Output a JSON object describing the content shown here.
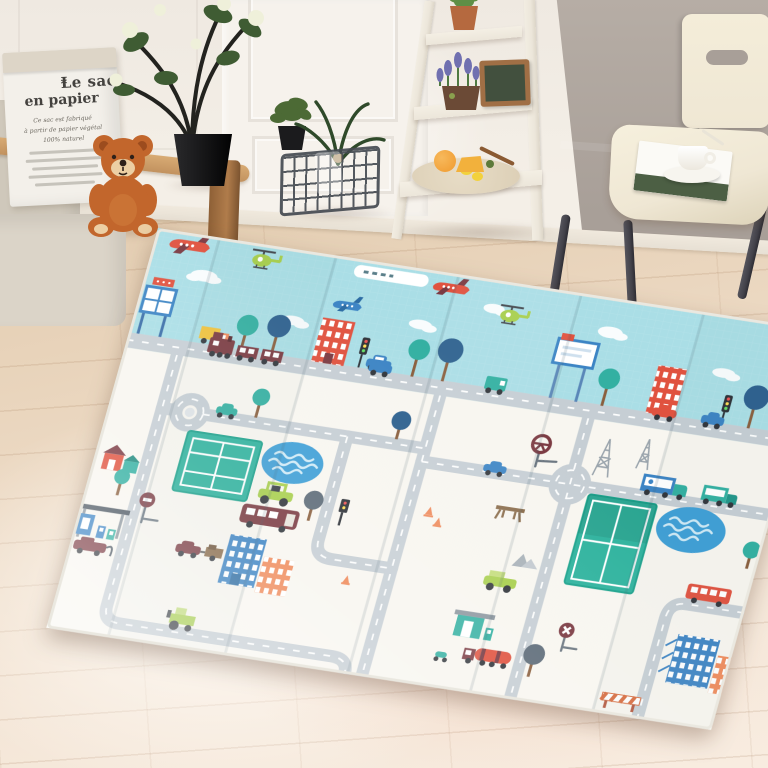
{
  "scene": {
    "title": "Living room with foldable baby play mat",
    "type": "product photograph"
  },
  "colors": {
    "wall_left": "#efe9e1",
    "wall_right": "#a89f98",
    "door": "#f6f2ec",
    "baseboard": "#e7e0d4",
    "floor": "#ecd9c3",
    "floor_deep": "#e2cbae",
    "sofa": "#cfc8bb",
    "sofa_seat": "#dbd4c8",
    "wood": "#c2925f",
    "wood_dark": "#8e6036",
    "bag": "#f3f0ea",
    "bag_shade": "#ddd5c7",
    "ink": "#44423f",
    "bear": "#c2662c",
    "bear_dark": "#9c4c1e",
    "muzzle": "#eccfa4",
    "pot": "#1b1b1d",
    "leaf": "#3f5c33",
    "flower": "#eff0da",
    "basket": "#464b52",
    "shelf": "#ece6da",
    "terracotta": "#b5693f",
    "lavender": "#7070b0",
    "frame": "#a06f45",
    "photo": "#42503e",
    "plate": "#dccfb6",
    "fruit_orange": "#f09a2e",
    "fruit_lemon": "#f2d13c",
    "spoon": "#8a5a32",
    "chair": "#efe7d4",
    "metal": "#43424a",
    "matSky": "#aadee6",
    "matBase": "#f8f6f0",
    "road": "#c6ced4",
    "roadDash": "#ffffff",
    "tennis": "#2fb39e",
    "tennisDark": "#1da38d",
    "pond": "#3f9fd6",
    "wave": "#cfeaf6",
    "maroon": "#7b3a42",
    "red": "#e0523f",
    "orange": "#ef8a5a",
    "blue": "#3c84c4",
    "teal": "#33b0a2",
    "navy": "#2e618f",
    "lime": "#a8cf4d",
    "green": "#4aa04f",
    "yellow": "#f2c43c",
    "treeGray": "#5d6b78",
    "crease": "rgba(70,95,105,0.15)"
  },
  "paper_bag": {
    "title": "Le sac",
    "title_mark": "*",
    "subtitle": "en papier",
    "lines": [
      "Ce sac est fabriqué",
      "à partir de papier végétal",
      "100% naturel"
    ]
  },
  "room": {
    "objects": [
      {
        "name": "armchair",
        "label": "beige armchair with wooden frame"
      },
      {
        "name": "paper-bag",
        "label": "Le sac en papier storage bag"
      },
      {
        "name": "teddy-bear",
        "label": "orange teddy bear"
      },
      {
        "name": "potted-plant",
        "label": "black planter with white roses"
      },
      {
        "name": "small-potted-plant",
        "label": "small green plant in black pot"
      },
      {
        "name": "wire-basket",
        "label": "dark wire basket with greenery"
      },
      {
        "name": "ladder-shelf",
        "label": "white ladder shelf"
      },
      {
        "name": "succulent-pot",
        "label": "terracotta succulent pot"
      },
      {
        "name": "lavender-pot",
        "label": "lavender in rustic pot"
      },
      {
        "name": "picture-frame",
        "label": "wooden picture frame"
      },
      {
        "name": "fruit-plate",
        "label": "plate with citrus fruit"
      },
      {
        "name": "dining-chair",
        "label": "cream chair with black metal legs"
      },
      {
        "name": "magazine",
        "label": "magazine on chair seat"
      },
      {
        "name": "coffee-cup",
        "label": "white coffee cup and saucer"
      }
    ]
  },
  "play_mat": {
    "label": "foldable baby play mat with town traffic print",
    "fold_panels": 6,
    "zones": [
      "sky with airplanes, helicopters and clouds",
      "tree-lined avenue with billboards, shops and cars",
      "white town with winding grey roads"
    ],
    "features": [
      "red airplane",
      "jet with contrail",
      "blue airplane",
      "green helicopters",
      "clouds",
      "billboards",
      "trees",
      "apartment blocks",
      "traffic lights",
      "train",
      "cars",
      "roundabout",
      "tennis courts",
      "ponds",
      "maroon bus",
      "red bus",
      "box trucks",
      "tanker truck",
      "lime tractor",
      "lime buggy",
      "gas stations",
      "no-entry signs",
      "power pylons",
      "picnic table",
      "rocks",
      "traffic cones",
      "road barrier",
      "houses"
    ]
  }
}
